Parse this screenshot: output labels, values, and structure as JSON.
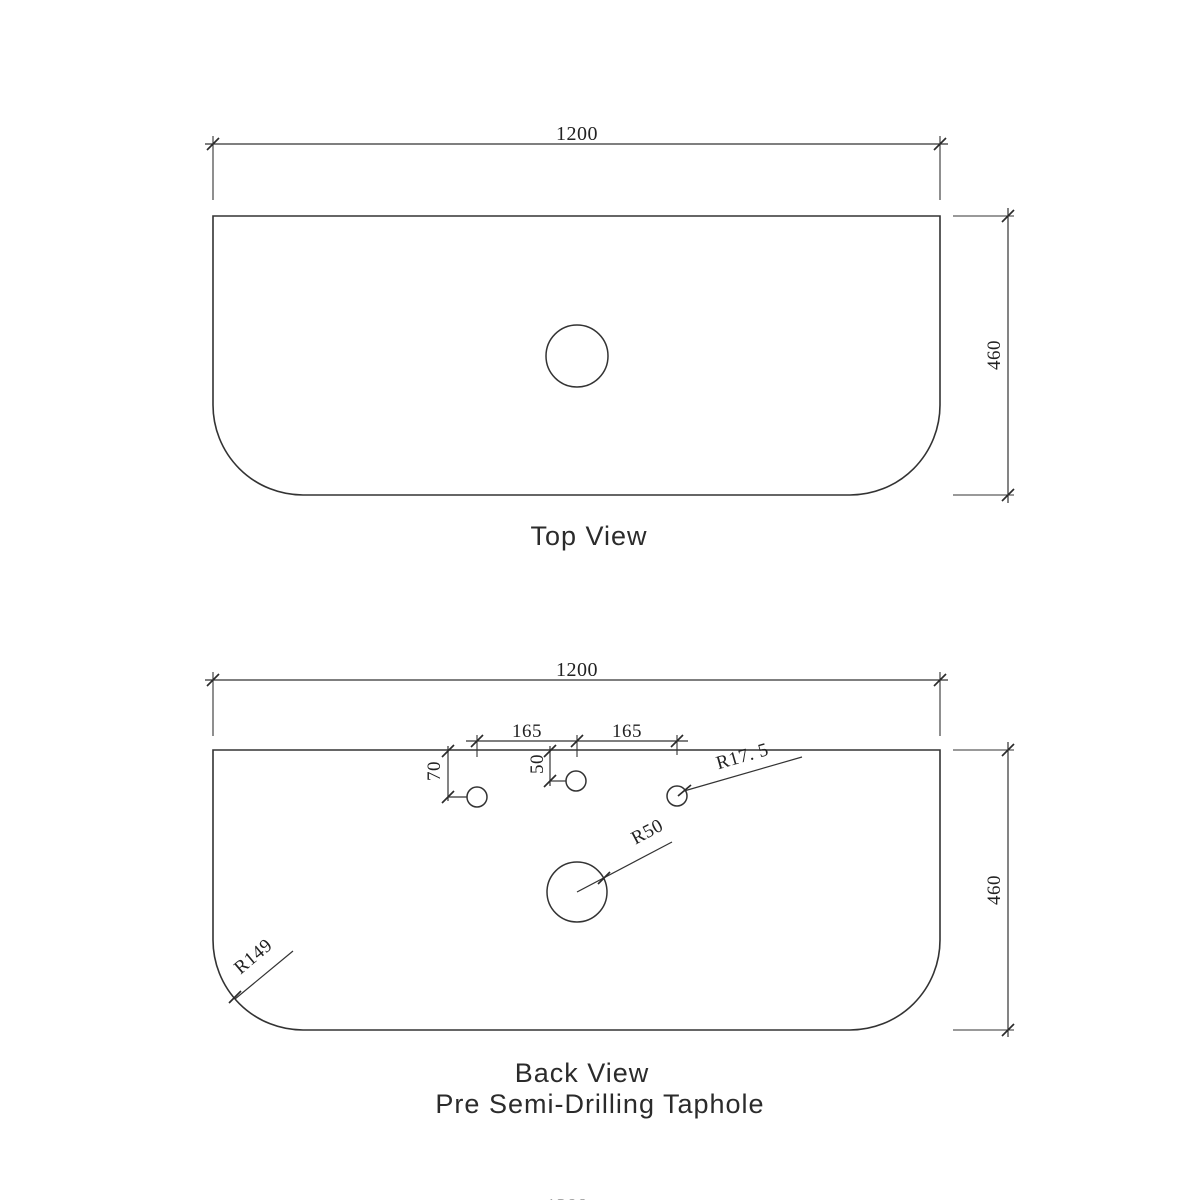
{
  "top_view": {
    "label": "Top View",
    "width_dim": "1200",
    "height_dim": "460"
  },
  "back_view": {
    "label": "Back View",
    "sublabel": "Pre Semi-Drilling Taphole",
    "width_dim": "1200",
    "height_dim": "460",
    "taphole_spacing_left": "165",
    "taphole_spacing_right": "165",
    "left_taphole_offset": "70",
    "center_taphole_offset": "50",
    "small_taphole_radius": "R17. 5",
    "waste_hole_radius": "R50",
    "corner_radius": "R149"
  },
  "partial_bottom_dim": "1200",
  "colors": {
    "line": "#333333",
    "text": "#222222",
    "background": "#ffffff"
  }
}
